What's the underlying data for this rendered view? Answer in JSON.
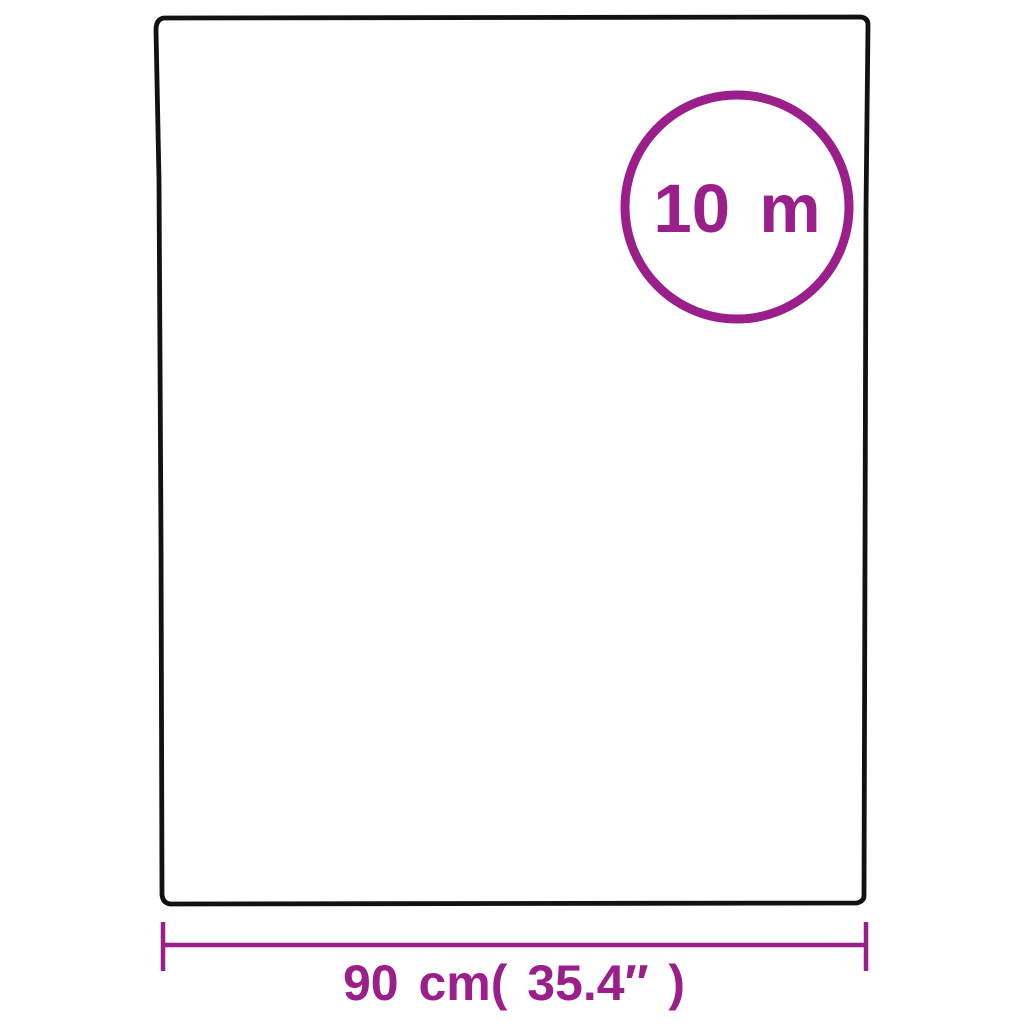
{
  "diagram": {
    "length_label": "10 m",
    "width_label": "90 cm( 35.4″ )",
    "colors": {
      "accent": "#9a1f8a",
      "outline": "#121212",
      "background": "#ffffff"
    }
  }
}
